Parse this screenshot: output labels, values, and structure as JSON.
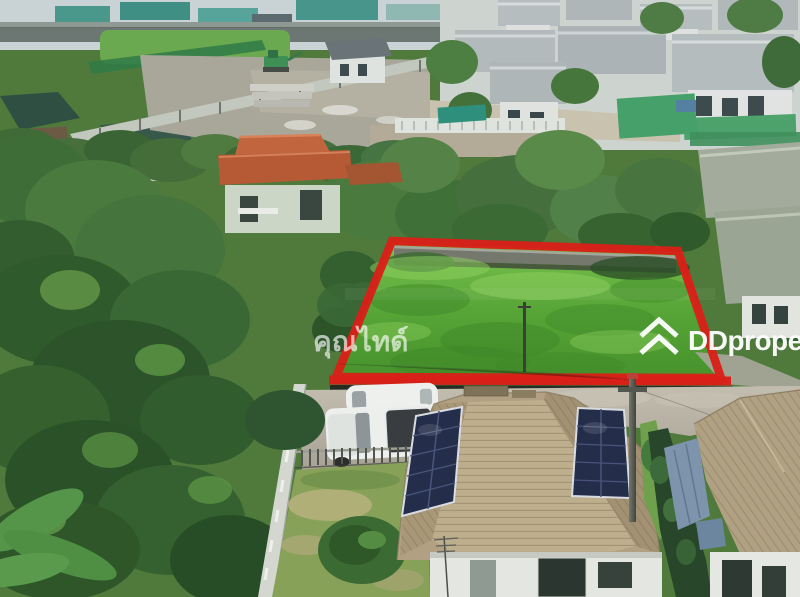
{
  "watermarks": {
    "agent": "คุณไทด์",
    "brand": "DDproperty"
  },
  "colors": {
    "plot_outline": "#da1f18",
    "watermark": "#ffffff",
    "plot_grass": "#5cab3b",
    "solar_panel": "#242d49",
    "foreground_roof": "#b1a182",
    "estate_roof": "#b4bcbe",
    "orange_roof": "#b55a35"
  }
}
